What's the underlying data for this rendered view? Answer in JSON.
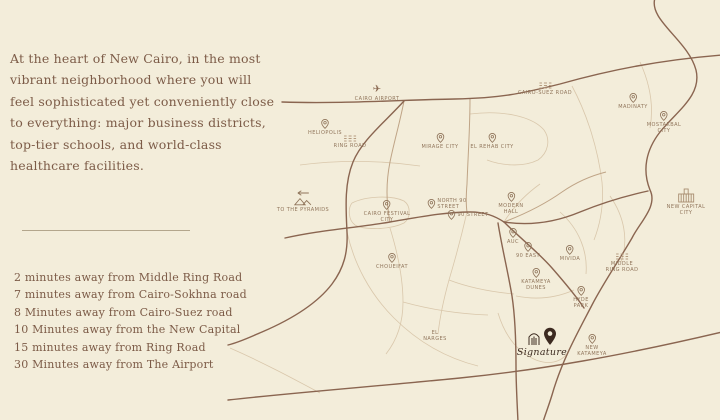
{
  "colors": {
    "background": "#f3edda",
    "text_brown": "#7c5b47",
    "map_line_major": "#8a6550",
    "map_line_minor": "#d9c7ab",
    "map_label": "#91765c",
    "brand_dark": "#3c2a20"
  },
  "intro": {
    "lines": [
      "At the heart of New Cairo, in the most",
      "vibrant neighborhood where you will",
      "feel sophisticated yet conveniently close",
      "to everything: major business districts,",
      "top-tier schools, and world-class",
      "healthcare facilities."
    ]
  },
  "distances": {
    "items": [
      "2 minutes away from Middle Ring Road",
      "7 minutes away from Cairo-Sokhna road",
      "8 Minutes away from Cairo-Suez road",
      "10 Minutes away from the New Capital",
      "15 minutes away from Ring Road",
      "30 Minutes away from The Airport"
    ]
  },
  "map": {
    "brand": {
      "name": "Signature"
    },
    "labels": [
      {
        "name": "heliopolis",
        "icon": "pin",
        "x": 325,
        "y": 119,
        "lines": [
          "HELIOPOLIS"
        ]
      },
      {
        "name": "cairo-airport",
        "icon": "plane",
        "x": 377,
        "y": 85,
        "lines": [
          "CAIRO AIRPORT"
        ]
      },
      {
        "name": "cairo-suez-road",
        "icon": "road",
        "x": 545,
        "y": 82,
        "lines": [
          "CAIRO-SUEZ ROAD"
        ]
      },
      {
        "name": "madinaty",
        "icon": "pin",
        "x": 633,
        "y": 93,
        "lines": [
          "MADINATY"
        ]
      },
      {
        "name": "mostakbal-city",
        "icon": "pin",
        "x": 664,
        "y": 111,
        "lines": [
          "MOSTAKBAL",
          "CITY"
        ]
      },
      {
        "name": "mirage-city",
        "icon": "pin",
        "x": 440,
        "y": 133,
        "lines": [
          "MIRAGE CITY"
        ]
      },
      {
        "name": "el-rehab-city",
        "icon": "pin",
        "x": 492,
        "y": 133,
        "lines": [
          "EL REHAB CITY"
        ]
      },
      {
        "name": "ring-road",
        "icon": "road",
        "x": 350,
        "y": 135,
        "lines": [
          "RING ROAD"
        ]
      },
      {
        "name": "to-the-pyramids",
        "icon": "pyramids",
        "x": 303,
        "y": 190,
        "lines": [
          "TO THE PYRAMIDS"
        ]
      },
      {
        "name": "cairo-festival-city",
        "icon": "pin",
        "x": 387,
        "y": 200,
        "lines": [
          "CAIRO FESTIVAL",
          "CITY"
        ]
      },
      {
        "name": "north-90-street",
        "icon": "pin",
        "row": true,
        "x": 447,
        "y": 198,
        "lines": [
          "NORTH 90",
          "STREET"
        ]
      },
      {
        "name": "90-street",
        "icon": "pin",
        "row": true,
        "x": 468,
        "y": 210,
        "lines": [
          "90 STREET"
        ]
      },
      {
        "name": "modern-hall",
        "icon": "pin",
        "x": 511,
        "y": 192,
        "lines": [
          "MODERN",
          "HALL"
        ]
      },
      {
        "name": "auc",
        "icon": "pin",
        "x": 513,
        "y": 228,
        "lines": [
          "AUC"
        ]
      },
      {
        "name": "90-east",
        "icon": "pin",
        "x": 528,
        "y": 242,
        "lines": [
          "90 EAST"
        ]
      },
      {
        "name": "mivida",
        "icon": "pin",
        "x": 570,
        "y": 245,
        "lines": [
          "MIVIDA"
        ]
      },
      {
        "name": "katameya-dunes",
        "icon": "pin",
        "x": 536,
        "y": 268,
        "lines": [
          "KATAMEYA",
          "DUNES"
        ]
      },
      {
        "name": "hyde-park",
        "icon": "pin",
        "x": 581,
        "y": 286,
        "lines": [
          "HYDE",
          "PARK"
        ]
      },
      {
        "name": "choueifat",
        "icon": "pin",
        "x": 392,
        "y": 253,
        "lines": [
          "CHOUEIFAT"
        ]
      },
      {
        "name": "el-narges",
        "icon": "none",
        "x": 435,
        "y": 330,
        "lines": [
          "EL",
          "NARGES"
        ]
      },
      {
        "name": "new-katameya",
        "icon": "pin",
        "x": 592,
        "y": 334,
        "lines": [
          "NEW",
          "KATAMEYA"
        ]
      },
      {
        "name": "new-capital-city",
        "icon": "capital",
        "x": 686,
        "y": 188,
        "lines": [
          "NEW CAPITAL",
          "CITY"
        ]
      },
      {
        "name": "middle-ring-road",
        "icon": "road",
        "x": 622,
        "y": 253,
        "lines": [
          "MIDDLE",
          "RING ROAD"
        ]
      }
    ]
  }
}
